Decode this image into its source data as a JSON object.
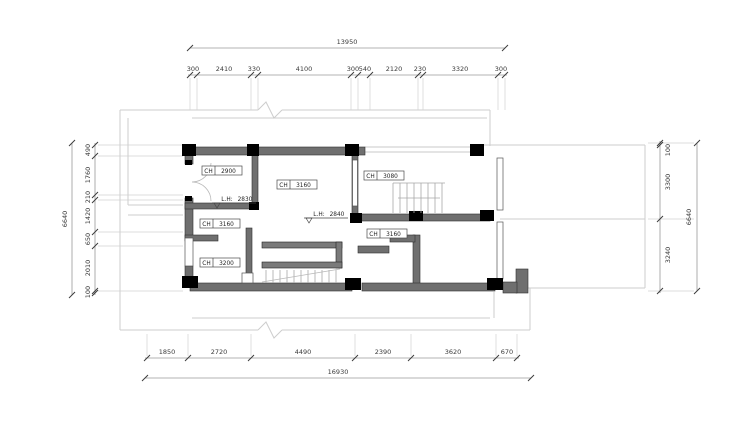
{
  "drawing": {
    "type": "architectural-floor-plan",
    "units": "mm"
  },
  "colors": {
    "background": "#ffffff",
    "wall_fill": "#6f6f6f",
    "column_fill": "#000000",
    "thin_line": "#cdcdcd",
    "dimension_line": "#9a9a9a",
    "text": "#3a3a3a"
  },
  "dimensions": {
    "top": {
      "total": "13950",
      "segments": [
        "300",
        "2410",
        "330",
        "4100",
        "300",
        "540",
        "2120",
        "230",
        "3320",
        "300"
      ]
    },
    "bottom": {
      "total": "16930",
      "segments": [
        "1850",
        "2720",
        "4490",
        "2390",
        "3620",
        "670"
      ]
    },
    "left": {
      "total": "6640",
      "segments": [
        "490",
        "1760",
        "210",
        "1420",
        "650",
        "2010",
        "100"
      ]
    },
    "right": {
      "total": "6640",
      "segments": [
        "100",
        "3300",
        "3240"
      ]
    }
  },
  "room_labels": [
    {
      "prefix": "CH",
      "value": "2900"
    },
    {
      "prefix": "CH",
      "value": "3160"
    },
    {
      "prefix": "CH",
      "value": "3080"
    },
    {
      "prefix": "CH",
      "value": "3160"
    },
    {
      "prefix": "CH",
      "value": "3200"
    },
    {
      "prefix": "CH",
      "value": "3160"
    }
  ],
  "level_labels": [
    {
      "prefix": "L.H:",
      "value": "2830"
    },
    {
      "prefix": "L.H:",
      "value": "2840"
    }
  ]
}
